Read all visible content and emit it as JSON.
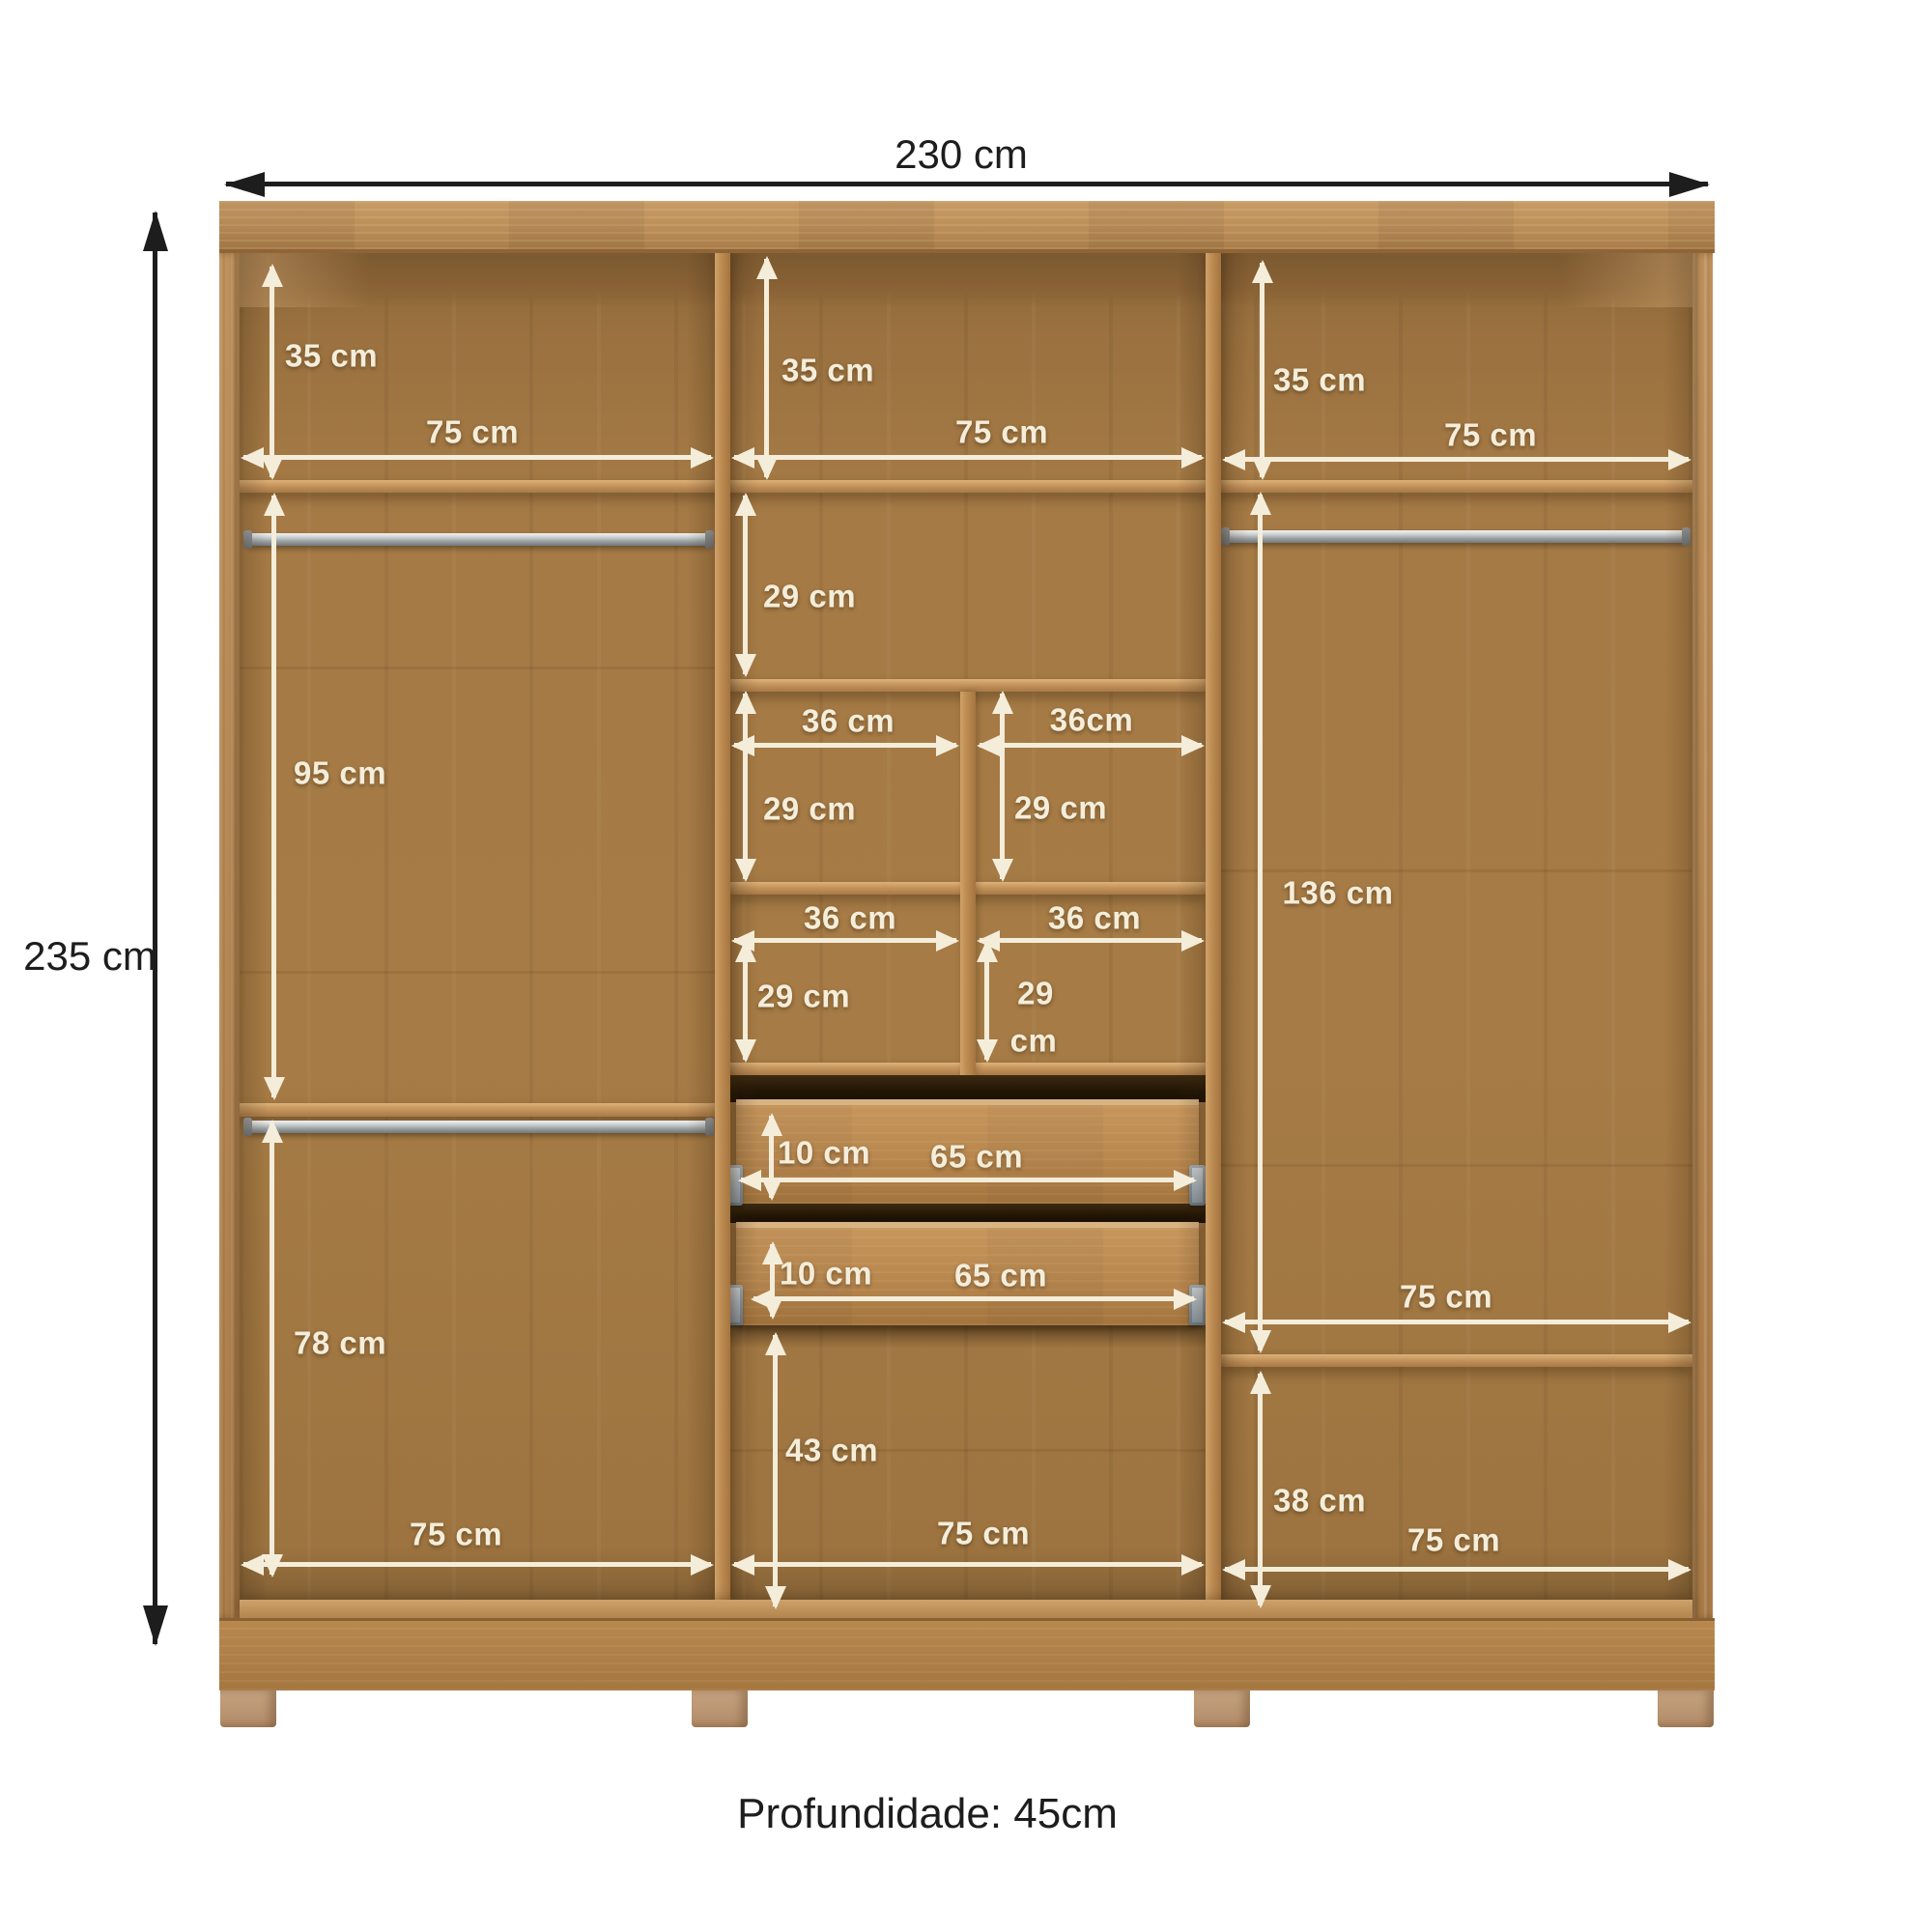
{
  "labels": {
    "overall_width": "230 cm",
    "overall_height": "235 cm",
    "top_left_height": "35 cm",
    "top_left_width": "75 cm",
    "top_middle_height": "35 cm",
    "top_middle_width": "75 cm",
    "top_right_height": "35 cm",
    "top_right_width": "75 cm",
    "left_upper_section_height": "95 cm",
    "left_lower_section_height": "78 cm",
    "left_bottom_width": "75 cm",
    "middle_shelf_height": "29 cm",
    "cubby_row1_left_width": "36 cm",
    "cubby_row1_right_width": "36cm",
    "cubby_row1_left_height": "29 cm",
    "cubby_row1_right_height": "29 cm",
    "cubby_row2_left_width": "36 cm",
    "cubby_row2_right_width": "36 cm",
    "cubby_row2_left_height": "29 cm",
    "cubby_row2_right_height_value": "29",
    "cubby_row2_right_height_unit": "cm",
    "drawer1_height": "10 cm",
    "drawer1_width": "65 cm",
    "drawer2_height": "10 cm",
    "drawer2_width": "65 cm",
    "middle_lower_space_height": "43 cm",
    "middle_bottom_width": "75 cm",
    "right_hanging_height": "136 cm",
    "right_shelf_width": "75 cm",
    "right_lower_section_height": "38 cm",
    "right_bottom_width": "75 cm",
    "depth_note": "Profundidade: 45cm"
  },
  "colors": {
    "wood_front": "#b9894f",
    "wood_interior": "#9d7443",
    "dimension_white": "#f4edda",
    "dimension_black": "#1d1d1d",
    "rod_metal": "#aeb3b5",
    "feet": "#bf9e7e",
    "background": "#ffffff"
  }
}
